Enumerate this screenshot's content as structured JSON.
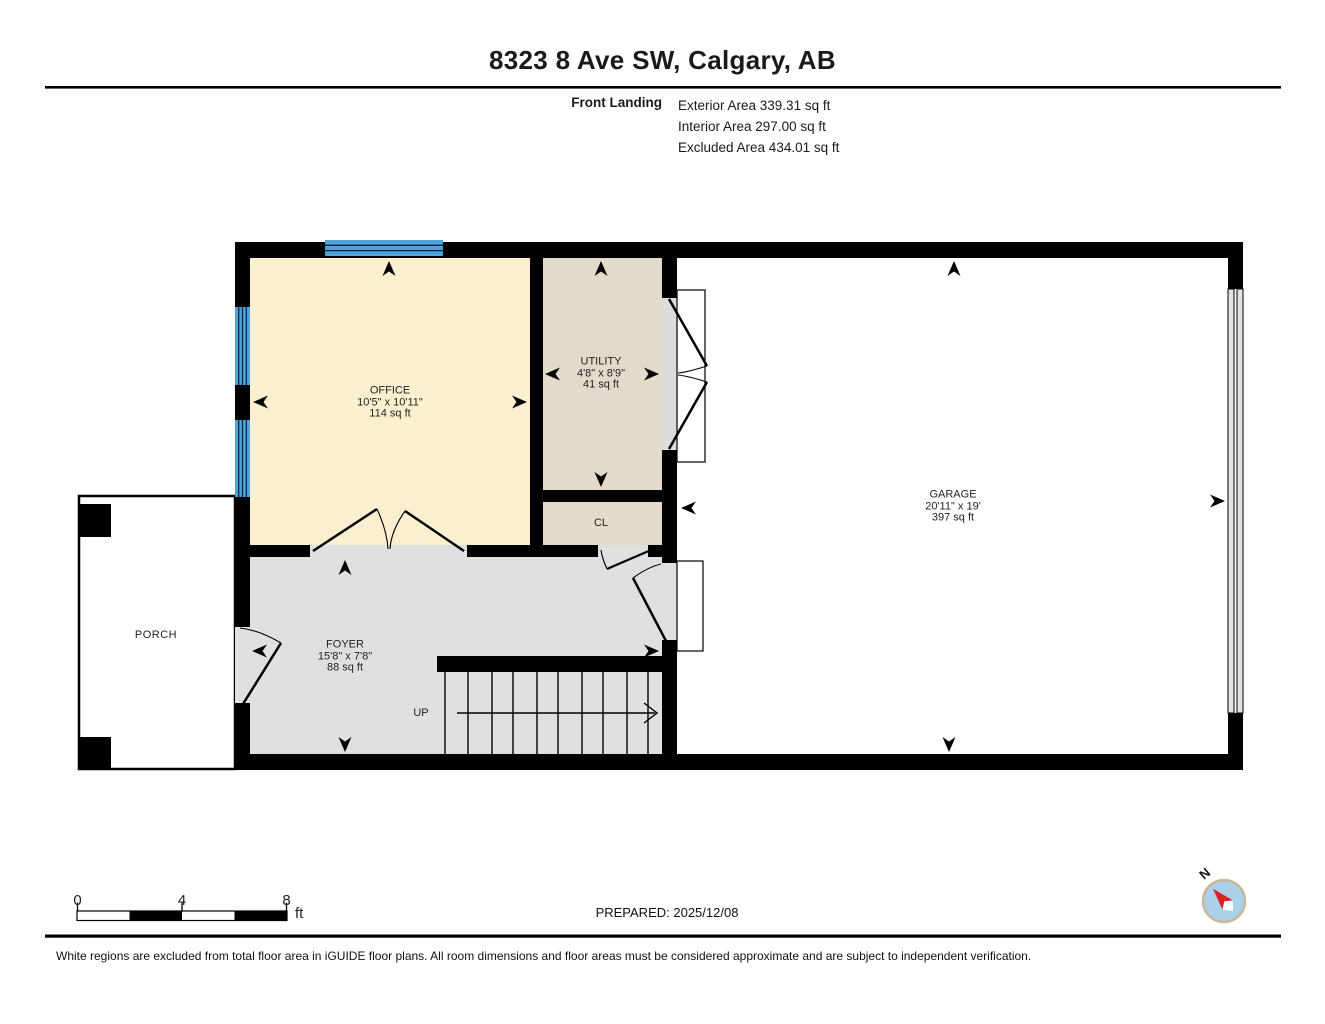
{
  "header": {
    "title": "8323 8 Ave SW, Calgary, AB",
    "level_name": "Front Landing",
    "areas": [
      "Exterior Area 339.31 sq ft",
      "Interior Area 297.00 sq ft",
      "Excluded Area 434.01 sq ft"
    ]
  },
  "rooms": {
    "office": {
      "name": "OFFICE",
      "dims": "10'5\" x 10'11\"",
      "area": "114 sq ft"
    },
    "utility": {
      "name": "UTILITY",
      "dims": "4'8\" x 8'9\"",
      "area": "41 sq ft"
    },
    "garage": {
      "name": "GARAGE",
      "dims": "20'11\" x 19'",
      "area": "397 sq ft"
    },
    "foyer": {
      "name": "FOYER",
      "dims": "15'8\" x 7'8\"",
      "area": "88 sq ft"
    },
    "closet": {
      "name": "CL"
    },
    "porch": {
      "name": "PORCH"
    }
  },
  "stairs": {
    "direction_label": "UP"
  },
  "scale_bar": {
    "labels": [
      "0",
      "4",
      "8"
    ],
    "unit": "ft"
  },
  "compass": {
    "north_label": "N"
  },
  "footer": {
    "prepared": "PREPARED: 2025/12/08",
    "disclaimer": "White regions are excluded from total floor area in iGUIDE floor plans. All room dimensions and floor areas must be considered approximate and are subject to independent verification."
  },
  "colors": {
    "wall": "#000000",
    "office_fill": "#FAF0CF",
    "utility_fill": "#E2DACB",
    "foyer_fill": "#E0E0E1",
    "window_blue": "#4FA3DB",
    "compass_face": "#ABD0E9",
    "compass_ring": "#C8B79A",
    "compass_needle": "#DD1F1F"
  }
}
